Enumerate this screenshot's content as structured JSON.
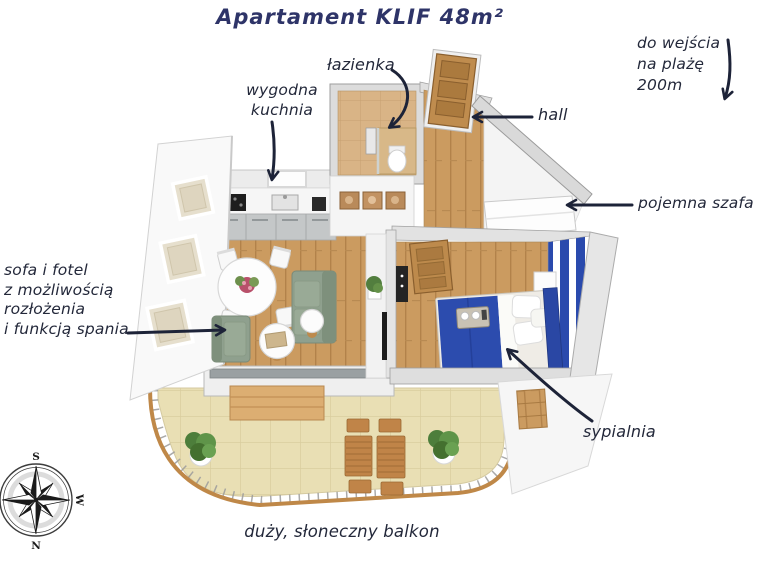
{
  "title": "Apartament KLIF 48m²",
  "labels": {
    "beach": [
      "do wejścia",
      "na plażę",
      "200m"
    ],
    "bathroom": "łazienka",
    "kitchen": [
      "wygodna",
      "kuchnia"
    ],
    "hall": "hall",
    "wardrobe": "pojemna szafa",
    "sofa": [
      "sofa i fotel",
      "z możliwością",
      "rozłożenia",
      "i funkcją spania"
    ],
    "bedroom": "sypialnia",
    "balcony": "duży, słoneczny balkon"
  },
  "compass": {
    "north": "N",
    "south": "S",
    "west": "W",
    "east": "E"
  },
  "colors": {
    "title_navy": "#2e3468",
    "label_ink": "#23283a",
    "arrow_ink": "#1d2338",
    "bed_blue": "#2c4cae",
    "stripe_blue": "#2a4aad",
    "wood_floor": "#cb9b60",
    "bathroom_tile": "#d9b486",
    "balcony_tile": "#e9dfb4",
    "sofa_green": "#8fa08e",
    "rail_wood": "#bf8848"
  }
}
